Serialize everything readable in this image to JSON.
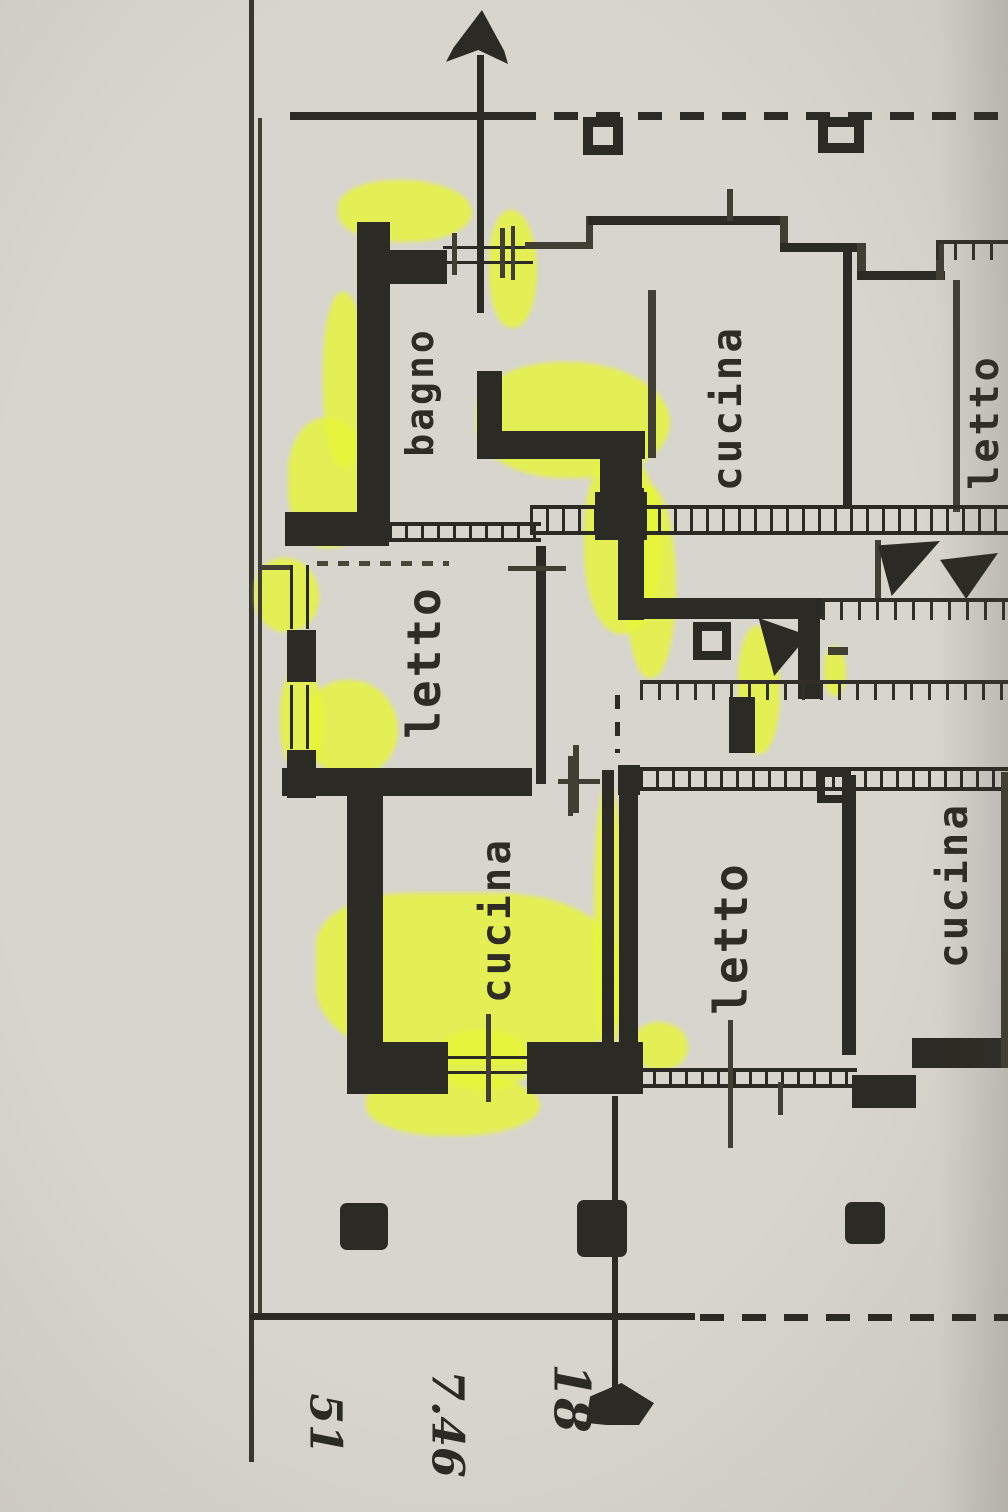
{
  "document": {
    "kind": "scanned floor plan photo with highlighter marks",
    "language": "Italian"
  },
  "colors": {
    "paper": "#d8d5ce",
    "ink": "#2c2a24",
    "highlighter": "#e7f637"
  },
  "compass": {
    "icon": "north-arrow"
  },
  "rooms": [
    {
      "id": "bagno-left",
      "label": "bagno"
    },
    {
      "id": "letto-left",
      "label": "letto"
    },
    {
      "id": "cucina-left",
      "label": "cucina"
    },
    {
      "id": "cucina-upper-right",
      "label": "cucina"
    },
    {
      "id": "letto-upper-right",
      "label": "letto"
    },
    {
      "id": "letto-lower",
      "label": "letto"
    },
    {
      "id": "cucina-lower-right",
      "label": "cucina"
    }
  ],
  "annotations": {
    "number_top": "18",
    "number_middle": "7.46",
    "number_bottom": "51"
  }
}
